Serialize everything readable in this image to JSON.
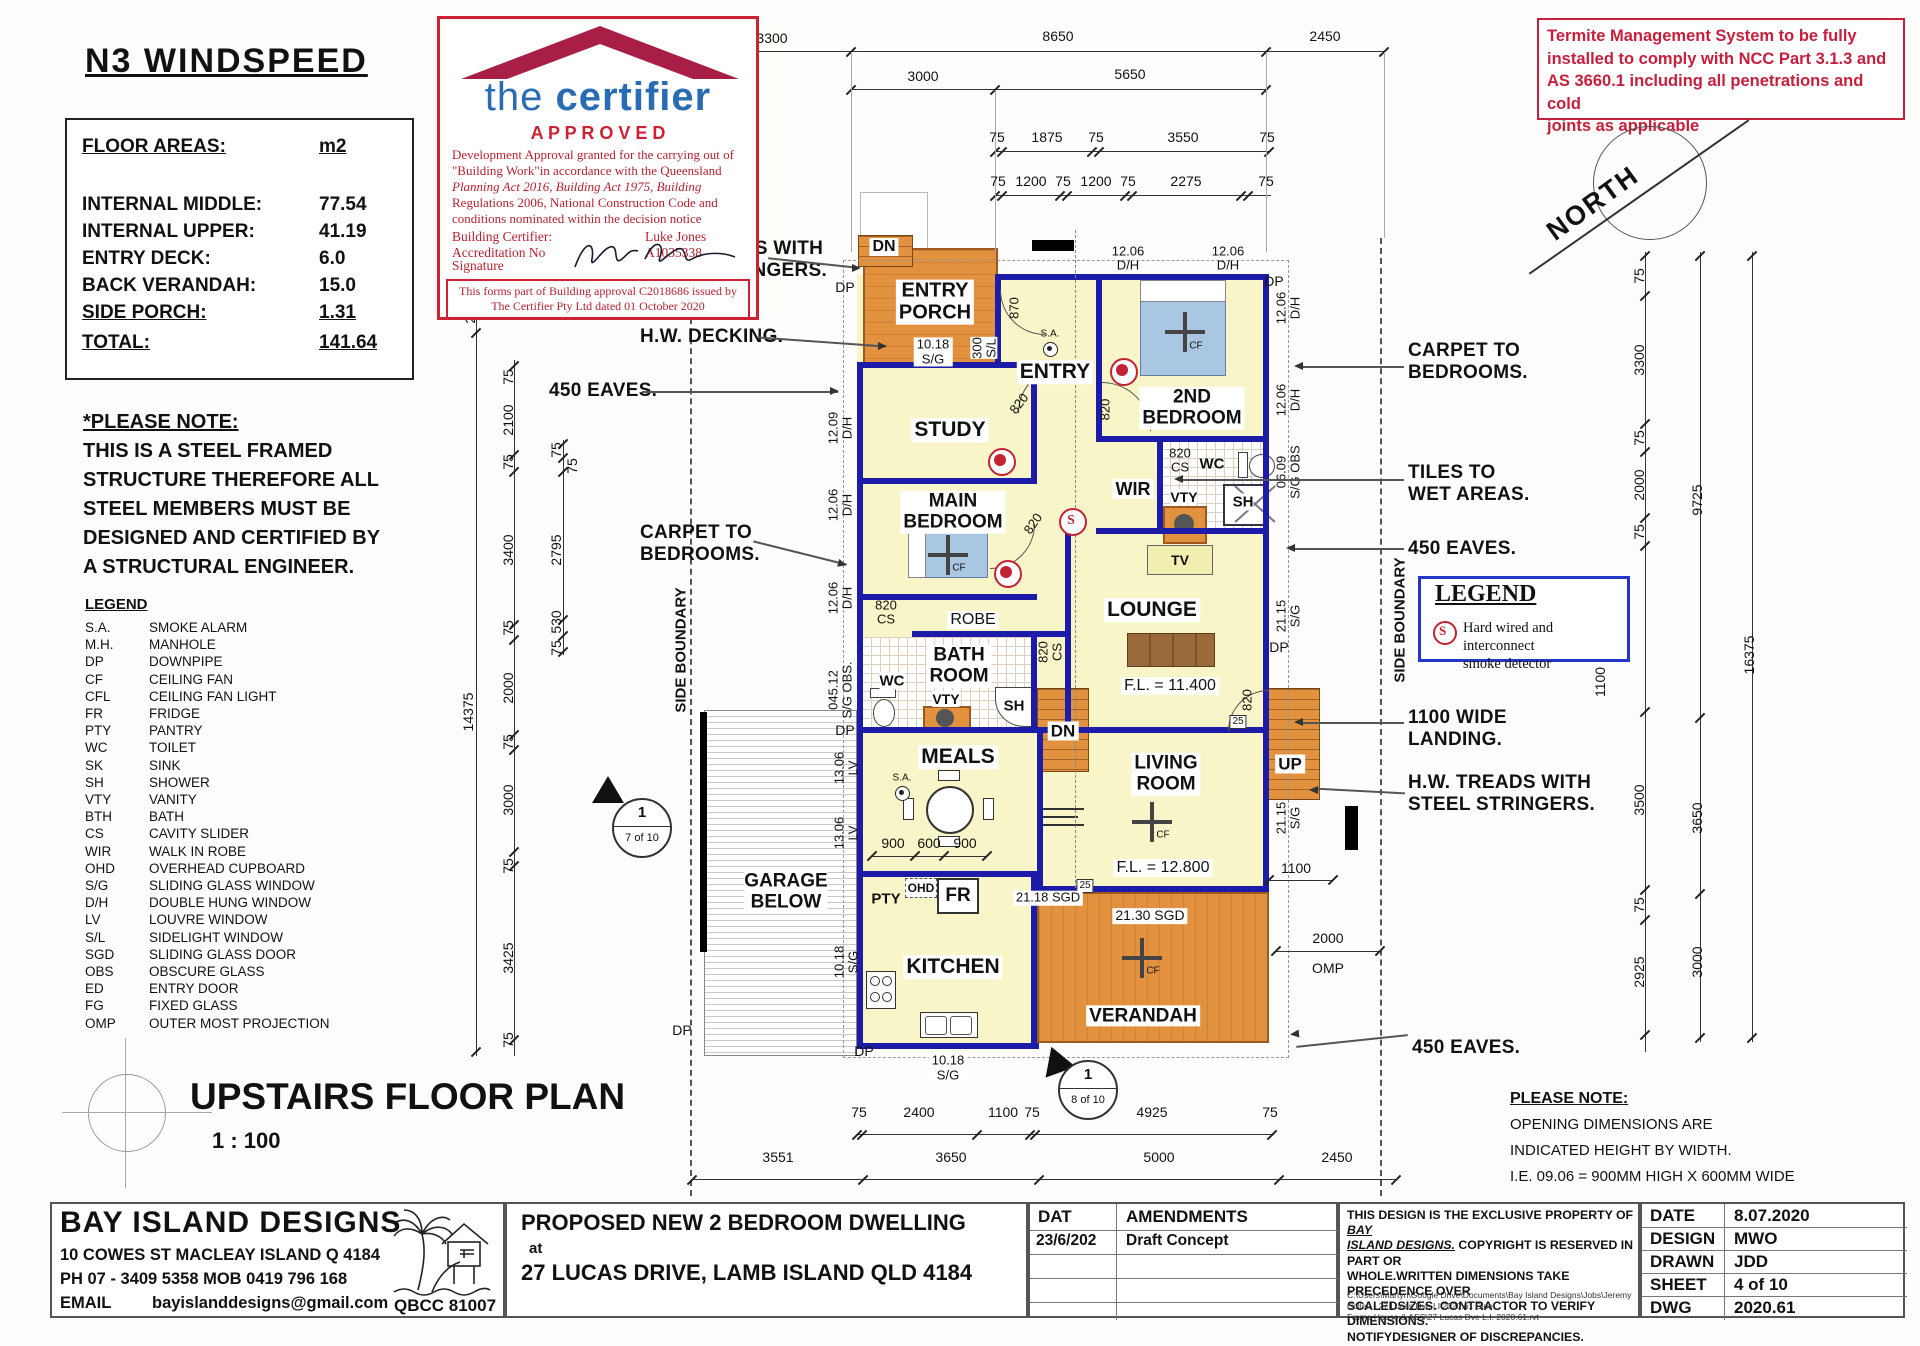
{
  "colors": {
    "wall_blue": "#1c1ca8",
    "room_yellow": "#f8f6c8",
    "deck_orange": "#e2923e",
    "bed_blue": "#a9c6e2",
    "stamp_red": "#cc2233",
    "brand_blue": "#2a6cb4",
    "roof_maroon": "#a81e45",
    "termite_red": "#c5203c",
    "legend_box_blue": "#2437c8"
  },
  "header": {
    "title": "N3 WINDSPEED"
  },
  "floor_areas": {
    "label": "FLOOR AREAS:",
    "unit": "m2",
    "rows": [
      [
        "INTERNAL MIDDLE:",
        "77.54"
      ],
      [
        "INTERNAL UPPER:",
        "41.19"
      ],
      [
        "ENTRY DECK:",
        "6.0"
      ],
      [
        "BACK VERANDAH:",
        "15.0"
      ],
      [
        "SIDE PORCH:",
        "1.31"
      ]
    ],
    "total": [
      "TOTAL:",
      "141.64"
    ]
  },
  "steel_note": [
    "*PLEASE NOTE:",
    "THIS IS A STEEL FRAMED",
    "STRUCTURE THEREFORE ALL",
    "STEEL MEMBERS MUST BE",
    "DESIGNED AND CERTIFIED BY",
    "A STRUCTURAL ENGINEER."
  ],
  "legend": {
    "title": "LEGEND",
    "items": [
      [
        "S.A.",
        "SMOKE ALARM"
      ],
      [
        "M.H.",
        "MANHOLE"
      ],
      [
        "DP",
        "DOWNPIPE"
      ],
      [
        "CF",
        "CEILING FAN"
      ],
      [
        "CFL",
        "CEILING FAN LIGHT"
      ],
      [
        "FR",
        "FRIDGE"
      ],
      [
        "PTY",
        "PANTRY"
      ],
      [
        "WC",
        "TOILET"
      ],
      [
        "SK",
        "SINK"
      ],
      [
        "SH",
        "SHOWER"
      ],
      [
        "VTY",
        "VANITY"
      ],
      [
        "BTH",
        "BATH"
      ],
      [
        "CS",
        "CAVITY SLIDER"
      ],
      [
        "WIR",
        "WALK IN ROBE"
      ],
      [
        "OHD",
        "OVERHEAD CUPBOARD"
      ],
      [
        "S/G",
        "SLIDING GLASS WINDOW"
      ],
      [
        "D/H",
        "DOUBLE HUNG WINDOW"
      ],
      [
        "LV",
        "LOUVRE WINDOW"
      ],
      [
        "S/L",
        "SIDELIGHT WINDOW"
      ],
      [
        "SGD",
        "SLIDING GLASS DOOR"
      ],
      [
        "OBS",
        "OBSCURE GLASS"
      ],
      [
        "ED",
        "ENTRY DOOR"
      ],
      [
        "FG",
        "FIXED GLASS"
      ],
      [
        "OMP",
        "OUTER MOST PROJECTION"
      ]
    ]
  },
  "plan_title": {
    "text": "UPSTAIRS FLOOR PLAN",
    "scale": "1 : 100"
  },
  "stamp": {
    "brand_the": "the",
    "brand_certifier": "certifier",
    "approved": "A P P R O V E D",
    "para": [
      "Development Approval granted for the carrying out of",
      "\"Building Work\"in accordance with the Queensland",
      "Planning Act 2016, Building Act 1975, Building",
      "Regulations 2006, National Construction Code and",
      "conditions nominated within the decision notice"
    ],
    "certifier_label": "Building Certifier:",
    "certifier_name": "Luke Jones",
    "accreditation_label": "Accreditation No",
    "accreditation_no": "A1035338",
    "signature_label": "Signature",
    "footer": [
      "This forms part of Building approval C2018686 issued by",
      "The Certifier Pty Ltd dated 01 October 2020"
    ]
  },
  "termite_note": [
    "Termite Management System to be fully",
    "installed to comply with NCC Part 3.1.3 and",
    "AS 3660.1 including all penetrations and cold",
    "joints as applicable"
  ],
  "north": "NORTH",
  "smoke_legend": {
    "title": "LEGEND",
    "symbol": "S",
    "lines": [
      "Hard wired and interconnect",
      "smoke detector"
    ]
  },
  "opening_note": [
    "PLEASE NOTE:",
    "OPENING DIMENSIONS ARE",
    "INDICATED HEIGHT BY WIDTH.",
    "I.E. 09.06 = 900MM HIGH X 600MM WIDE"
  ],
  "callouts": {
    "left": [
      "H.W. TREADS WITH",
      "STEEL STRINGERS.",
      "H.W. DECKING.",
      "450 EAVES.",
      "CARPET TO",
      "BEDROOMS."
    ],
    "right": [
      "CARPET TO",
      "BEDROOMS.",
      "TILES TO",
      "WET AREAS.",
      "450 EAVES.",
      "1100 WIDE",
      "LANDING.",
      "H.W. TREADS WITH",
      "STEEL STRINGERS.",
      "450 EAVES."
    ]
  },
  "markers": {
    "left_num": "1",
    "left_sheet": "7 of 10",
    "bottom_num": "1",
    "bottom_sheet": "8 of 10"
  },
  "boundary_label": "SIDE BOUNDARY",
  "rooms": {
    "entry_porch": [
      "ENTRY",
      "PORCH"
    ],
    "entry": "ENTRY",
    "study": "STUDY",
    "bed2": [
      "2ND",
      "BEDROOM"
    ],
    "main_bed": [
      "MAIN",
      "BEDROOM"
    ],
    "wir": "WIR",
    "wc": "WC",
    "sh": "SH",
    "vty": "VTY",
    "bath": [
      "BATH",
      "ROOM"
    ],
    "robe": "ROBE",
    "lounge": "LOUNGE",
    "meals": "MEALS",
    "living": [
      "LIVING",
      "ROOM"
    ],
    "kitchen": "KITCHEN",
    "verandah": "VERANDAH",
    "garage": [
      "GARAGE",
      "BELOW"
    ],
    "tv": "TV",
    "pty": "PTY",
    "ohd": "OHD",
    "fr": "FR",
    "dn": "DN",
    "up": "UP",
    "sa": "S.A.",
    "cf": "CF",
    "dp": "DP",
    "s_symbol": "S"
  },
  "fl": {
    "lounge": "F.L. = 11.400",
    "living": "F.L. = 12.800"
  },
  "openings": {
    "left": [
      [
        "12.09",
        "D/H"
      ],
      [
        "12.06",
        "D/H"
      ],
      [
        "12.06",
        "D/H"
      ],
      [
        "045.12",
        "S/G OBS."
      ],
      [
        "13.06",
        "LV"
      ],
      [
        "13.06",
        "LV"
      ],
      [
        "10.18",
        "S/G"
      ]
    ],
    "right": [
      [
        "12.06",
        "D/H"
      ],
      [
        "12.06",
        "D/H"
      ],
      [
        "06.09",
        "S/G OBS"
      ],
      [
        "21.15",
        "S/G"
      ],
      [
        "21.15",
        "S/G"
      ]
    ],
    "top": [
      [
        "12.06",
        "D/H"
      ],
      [
        "12.06",
        "D/H"
      ]
    ],
    "porch_win": [
      "10.18",
      "S/G"
    ],
    "porch_side": [
      "300",
      "S/L"
    ],
    "entry_door": "870",
    "door": "820",
    "cs": "CS",
    "n25": "25",
    "sgd_living": "21.30 SGD",
    "sgd_kitchen": "21.18 SGD",
    "bottom_win": [
      "10.18",
      "S/G"
    ]
  },
  "dims": {
    "top1": [
      "3300",
      "8650",
      "2450"
    ],
    "top2": [
      "3000",
      "5650"
    ],
    "top3": [
      "75",
      "1875",
      "75",
      "3550",
      "75"
    ],
    "top4": [
      "75",
      "1200",
      "75",
      "1200",
      "75",
      "2275",
      "75"
    ],
    "left_outer": [
      "200",
      "14375"
    ],
    "left_mid": [
      "75",
      "2100",
      "75",
      "3400",
      "75",
      "2000",
      "75",
      "3000",
      "75",
      "3425",
      "75"
    ],
    "left_inner": [
      "75",
      "75",
      "2795",
      "530",
      "75"
    ],
    "right_col1": [
      "75",
      "3300",
      "75",
      "2000",
      "75",
      "3500",
      "75",
      "2925"
    ],
    "right_col2": [
      "9725",
      "3650",
      "3000"
    ],
    "right_col3": [
      "16375"
    ],
    "right_extra": [
      "4200",
      "1100"
    ],
    "bottom1": [
      "75",
      "2400",
      "1100",
      "75",
      "4925",
      "75"
    ],
    "bottom2": [
      "3551",
      "3650",
      "5000",
      "2450"
    ],
    "meals": [
      "900",
      "600",
      "900"
    ],
    "living_side": "1100",
    "omp": [
      "2000",
      "OMP"
    ]
  },
  "title_block": {
    "company": {
      "name": "BAY ISLAND DESIGNS",
      "address": "10 COWES ST  MACLEAY ISLAND Q 4184",
      "phone": "PH 07 - 3409 5358    MOB 0419 796 168",
      "email_label": "EMAIL",
      "email": "bayislanddesigns@gmail.com",
      "qbcc": "QBCC  81007"
    },
    "project": {
      "line1": "PROPOSED NEW 2 BEDROOM DWELLING",
      "at": "at",
      "line2": "27 LUCAS DRIVE,  LAMB ISLAND  QLD 4184"
    },
    "amendments": {
      "col1": "DAT",
      "col2": "AMENDMENTS",
      "row_date": "23/6/202",
      "row_desc": "Draft Concept"
    },
    "copyright": {
      "l1a": "THIS DESIGN IS THE EXCLUSIVE PROPERTY OF ",
      "l1b": "BAY",
      "l2a": "ISLAND DESIGNS.",
      "l2b": " COPYRIGHT IS RESERVED IN PART OR",
      "l3": "WHOLE.WRITTEN DIMENSIONS TAKE PRECEDENCE OVER",
      "l4": "SCALEDSIZES. CONTRACTOR TO VERIFY DIMENSIONS.",
      "l5": "NOTIFYDESIGNER OF DISCREPANCIES.",
      "path1": "C:\\Users\\Martyn\\Google Drive\\Documents\\Bay Island Designs\\Jobs\\Jeremy Collett - 27 Lucas Dve LI 2020.61 Steel",
      "path2": "Frame House & AES\\27 Lucas Dve L.I. 2020.61.rvt"
    },
    "info": {
      "rows": [
        [
          "DATE",
          "8.07.2020"
        ],
        [
          "DESIGN",
          "MWO"
        ],
        [
          "DRAWN",
          "JDD"
        ],
        [
          "SHEET",
          "4 of 10"
        ],
        [
          "DWG",
          "2020.61"
        ]
      ]
    }
  }
}
